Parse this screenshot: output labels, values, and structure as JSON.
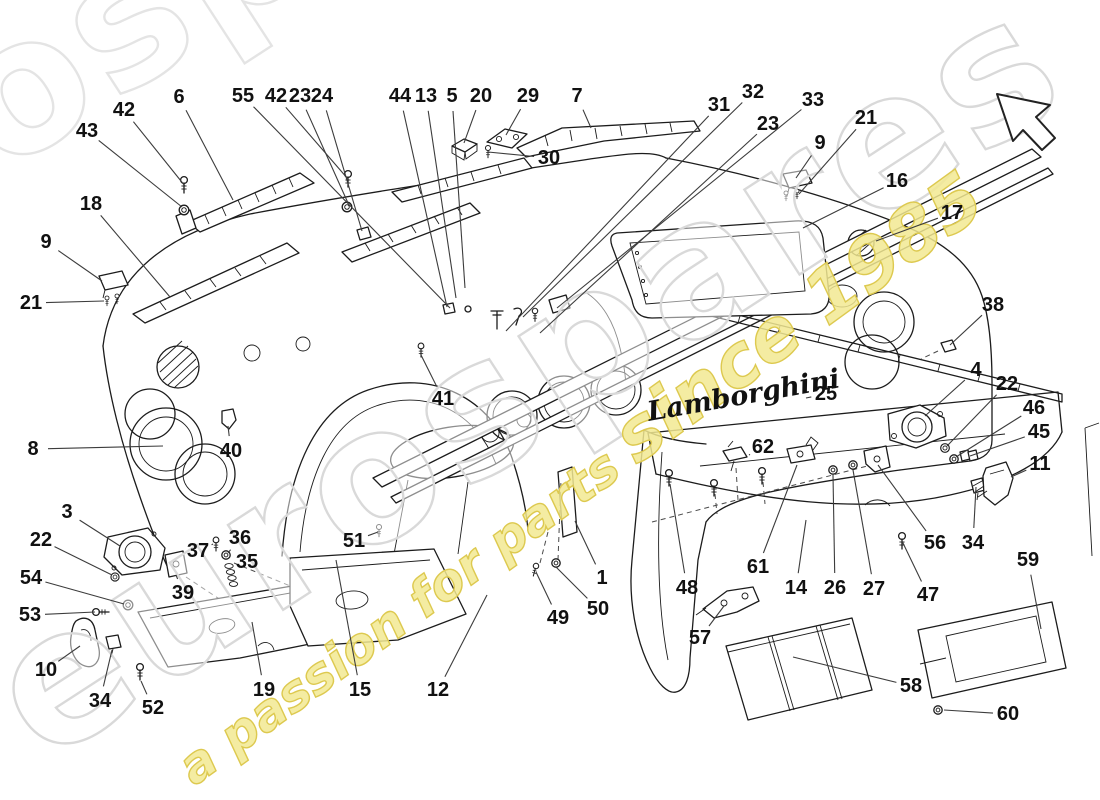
{
  "page": {
    "background": "#ffffff",
    "colors": {
      "ink": "#1c1c1c",
      "leader": "#3c3c3c",
      "label": "#111111",
      "watermark_gray": "#d9d9d9",
      "watermark_yellow_fill": "#f2e992",
      "watermark_yellow_stroke": "#ddc94f"
    }
  },
  "watermark": {
    "main_text": "eurospares",
    "tagline_left": "a passion for parts",
    "tagline_right": "since 1985"
  },
  "brand": {
    "script_text": "Lamborghini"
  },
  "icons": {
    "nav_arrow": "nw-cursor-arrow"
  },
  "diagram": {
    "labels": [
      {
        "id": "43",
        "n": "43",
        "x": 87,
        "y": 131,
        "tx": 182,
        "ty": 207
      },
      {
        "id": "42a",
        "n": "42",
        "x": 124,
        "y": 110,
        "tx": 185,
        "ty": 186
      },
      {
        "id": "6",
        "n": "6",
        "x": 179,
        "y": 97,
        "tx": 233,
        "ty": 200
      },
      {
        "id": "55",
        "n": "55",
        "x": 243,
        "y": 96,
        "tx": 450,
        "ty": 308
      },
      {
        "id": "42b",
        "n": "42",
        "x": 276,
        "y": 96,
        "tx": 348,
        "ty": 179
      },
      {
        "id": "23a",
        "n": "23",
        "x": 300,
        "y": 96,
        "tx": 348,
        "ty": 203
      },
      {
        "id": "24",
        "n": "24",
        "x": 322,
        "y": 96,
        "tx": 362,
        "ty": 231
      },
      {
        "id": "44",
        "n": "44",
        "x": 400,
        "y": 96,
        "tx": 447,
        "ty": 307
      },
      {
        "id": "13",
        "n": "13",
        "x": 426,
        "y": 96,
        "tx": 456,
        "ty": 298
      },
      {
        "id": "5",
        "n": "5",
        "x": 452,
        "y": 96,
        "tx": 465,
        "ty": 288
      },
      {
        "id": "20",
        "n": "20",
        "x": 481,
        "y": 96,
        "tx": 464,
        "ty": 143
      },
      {
        "id": "29",
        "n": "29",
        "x": 528,
        "y": 96,
        "tx": 506,
        "ty": 135
      },
      {
        "id": "7",
        "n": "7",
        "x": 577,
        "y": 96,
        "tx": 591,
        "ty": 128
      },
      {
        "id": "30",
        "n": "30",
        "x": 549,
        "y": 158,
        "tx": 488,
        "ty": 152
      },
      {
        "id": "31",
        "n": "31",
        "x": 719,
        "y": 105,
        "tx": 506,
        "ty": 331
      },
      {
        "id": "32",
        "n": "32",
        "x": 753,
        "y": 92,
        "tx": 523,
        "ty": 317
      },
      {
        "id": "23b",
        "n": "23",
        "x": 768,
        "y": 124,
        "tx": 540,
        "ty": 333
      },
      {
        "id": "33",
        "n": "33",
        "x": 813,
        "y": 100,
        "tx": 557,
        "ty": 308
      },
      {
        "id": "9t",
        "n": "9",
        "x": 820,
        "y": 143,
        "tx": 796,
        "ty": 178
      },
      {
        "id": "21t",
        "n": "21",
        "x": 866,
        "y": 118,
        "tx": 799,
        "ty": 194
      },
      {
        "id": "16",
        "n": "16",
        "x": 897,
        "y": 181,
        "tx": 803,
        "ty": 228
      },
      {
        "id": "17",
        "n": "17",
        "x": 952,
        "y": 213,
        "tx": 876,
        "ty": 241
      },
      {
        "id": "38",
        "n": "38",
        "x": 993,
        "y": 305,
        "tx": 950,
        "ty": 345
      },
      {
        "id": "4",
        "n": "4",
        "x": 976,
        "y": 370,
        "tx": 925,
        "ty": 416
      },
      {
        "id": "22r",
        "n": "22",
        "x": 1007,
        "y": 384,
        "tx": 947,
        "ty": 446
      },
      {
        "id": "46",
        "n": "46",
        "x": 1034,
        "y": 408,
        "tx": 956,
        "ty": 457
      },
      {
        "id": "45",
        "n": "45",
        "x": 1039,
        "y": 432,
        "tx": 970,
        "ty": 456
      },
      {
        "id": "11",
        "n": "11",
        "x": 1040,
        "y": 464,
        "tx": 1011,
        "ty": 477
      },
      {
        "id": "18",
        "n": "18",
        "x": 91,
        "y": 204,
        "tx": 170,
        "ty": 297
      },
      {
        "id": "9l",
        "n": "9",
        "x": 46,
        "y": 242,
        "tx": 102,
        "ty": 281
      },
      {
        "id": "21l",
        "n": "21",
        "x": 31,
        "y": 303,
        "tx": 104,
        "ty": 301
      },
      {
        "id": "8",
        "n": "8",
        "x": 33,
        "y": 449,
        "tx": 163,
        "ty": 446
      },
      {
        "id": "3",
        "n": "3",
        "x": 67,
        "y": 512,
        "tx": 120,
        "ty": 546
      },
      {
        "id": "22l",
        "n": "22",
        "x": 41,
        "y": 540,
        "tx": 112,
        "ty": 575
      },
      {
        "id": "54",
        "n": "54",
        "x": 31,
        "y": 578,
        "tx": 124,
        "ty": 604
      },
      {
        "id": "53",
        "n": "53",
        "x": 30,
        "y": 615,
        "tx": 95,
        "ty": 612
      },
      {
        "id": "10",
        "n": "10",
        "x": 46,
        "y": 670,
        "tx": 80,
        "ty": 646
      },
      {
        "id": "34l",
        "n": "34",
        "x": 100,
        "y": 701,
        "tx": 112,
        "ty": 650
      },
      {
        "id": "52",
        "n": "52",
        "x": 153,
        "y": 708,
        "tx": 141,
        "ty": 681
      },
      {
        "id": "39",
        "n": "39",
        "x": 183,
        "y": 593,
        "tx": 176,
        "ty": 575
      },
      {
        "id": "37",
        "n": "37",
        "x": 198,
        "y": 551,
        "tx": 213,
        "ty": 544
      },
      {
        "id": "36",
        "n": "36",
        "x": 240,
        "y": 538,
        "tx": 228,
        "ty": 553
      },
      {
        "id": "35",
        "n": "35",
        "x": 247,
        "y": 562,
        "tx": 233,
        "ty": 571
      },
      {
        "id": "40",
        "n": "40",
        "x": 231,
        "y": 451,
        "tx": 228,
        "ty": 426
      },
      {
        "id": "41",
        "n": "41",
        "x": 443,
        "y": 399,
        "tx": 421,
        "ty": 355
      },
      {
        "id": "51",
        "n": "51",
        "x": 354,
        "y": 541,
        "tx": 378,
        "ty": 532
      },
      {
        "id": "19",
        "n": "19",
        "x": 264,
        "y": 690,
        "tx": 252,
        "ty": 622
      },
      {
        "id": "15",
        "n": "15",
        "x": 360,
        "y": 690,
        "tx": 336,
        "ty": 560
      },
      {
        "id": "12",
        "n": "12",
        "x": 438,
        "y": 690,
        "tx": 487,
        "ty": 595
      },
      {
        "id": "49",
        "n": "49",
        "x": 558,
        "y": 618,
        "tx": 536,
        "ty": 572
      },
      {
        "id": "50",
        "n": "50",
        "x": 598,
        "y": 609,
        "tx": 556,
        "ty": 567
      },
      {
        "id": "1",
        "n": "1",
        "x": 602,
        "y": 578,
        "tx": 575,
        "ty": 521
      },
      {
        "id": "48",
        "n": "48",
        "x": 687,
        "y": 588,
        "tx": 670,
        "ty": 484
      },
      {
        "id": "57",
        "n": "57",
        "x": 700,
        "y": 638,
        "tx": 724,
        "ty": 606
      },
      {
        "id": "61",
        "n": "61",
        "x": 758,
        "y": 567,
        "tx": 797,
        "ty": 465
      },
      {
        "id": "14",
        "n": "14",
        "x": 796,
        "y": 588,
        "tx": 806,
        "ty": 520
      },
      {
        "id": "26",
        "n": "26",
        "x": 835,
        "y": 588,
        "tx": 833,
        "ty": 475
      },
      {
        "id": "27",
        "n": "27",
        "x": 874,
        "y": 589,
        "tx": 853,
        "ty": 470
      },
      {
        "id": "47",
        "n": "47",
        "x": 928,
        "y": 595,
        "tx": 902,
        "ty": 541
      },
      {
        "id": "56",
        "n": "56",
        "x": 935,
        "y": 543,
        "tx": 878,
        "ty": 465
      },
      {
        "id": "34r",
        "n": "34",
        "x": 973,
        "y": 543,
        "tx": 976,
        "ty": 487
      },
      {
        "id": "62",
        "n": "62",
        "x": 763,
        "y": 447,
        "tx": 749,
        "ty": 455
      },
      {
        "id": "25",
        "n": "25",
        "x": 826,
        "y": 394,
        "tx": 806,
        "ty": 398
      },
      {
        "id": "59",
        "n": "59",
        "x": 1028,
        "y": 560,
        "tx": 1041,
        "ty": 629
      },
      {
        "id": "58",
        "n": "58",
        "x": 911,
        "y": 686,
        "tx": 793,
        "ty": 657
      },
      {
        "id": "60",
        "n": "60",
        "x": 1008,
        "y": 714,
        "tx": 944,
        "ty": 710
      }
    ]
  }
}
